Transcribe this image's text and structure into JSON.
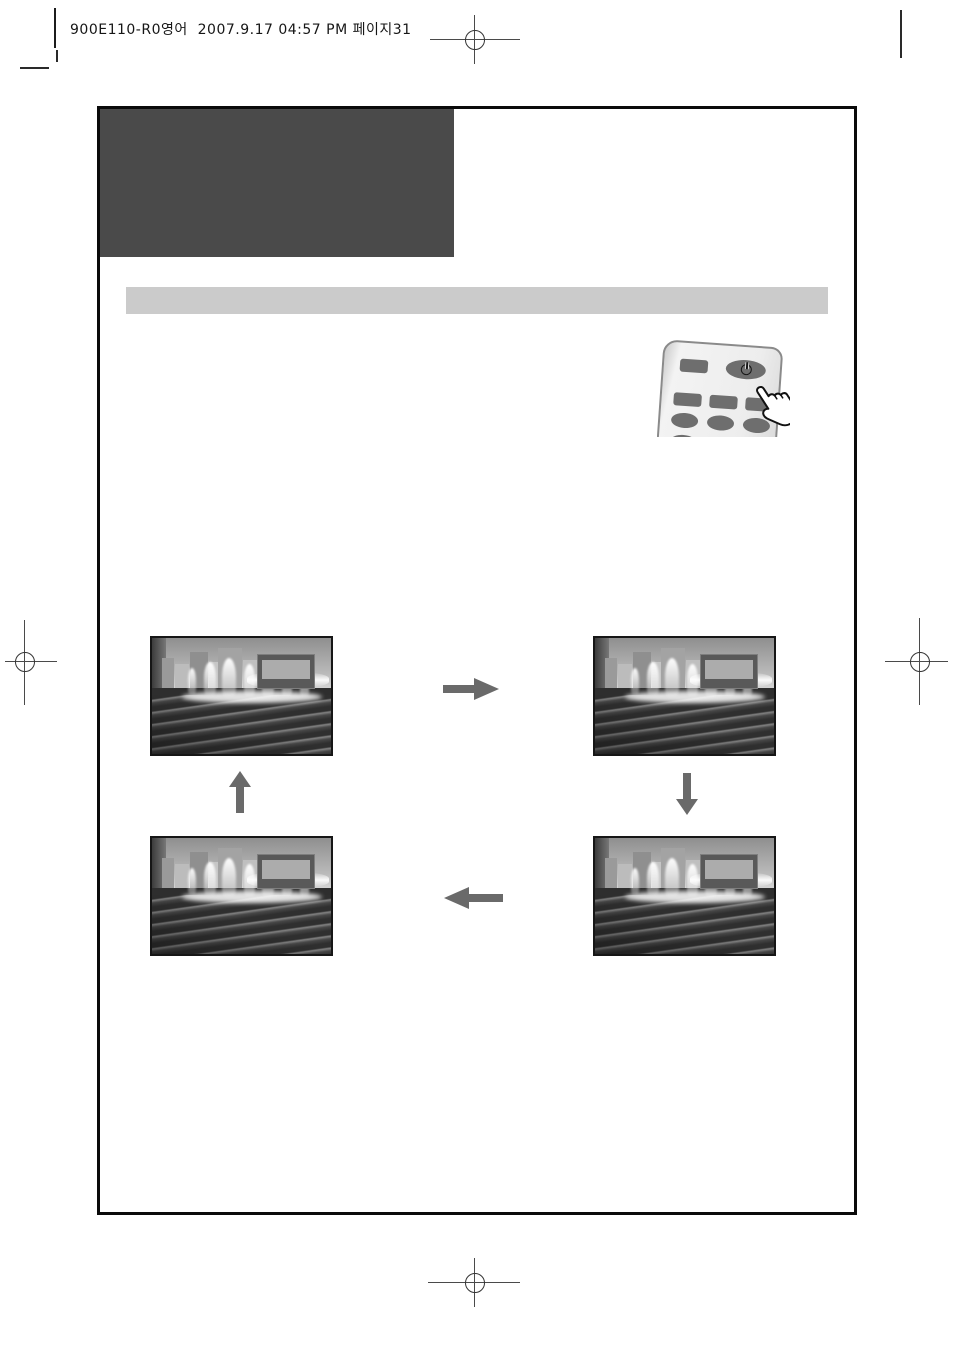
{
  "document": {
    "print_header": "900E110-R0영어  2007.9.17 04:57 PM 페이지31"
  },
  "title_block": {
    "text": ""
  },
  "section_bar": {
    "text": ""
  },
  "remote_illustration": {
    "power_icon": "power-symbol-circle-with-bar",
    "pressed_button": "row2-right-button",
    "hand": "finger-pressing-button"
  },
  "cycle_diagram": {
    "screens": [
      {
        "id": "top-left",
        "content": "fountain-plaza-photo",
        "overlay": "osd-box"
      },
      {
        "id": "top-right",
        "content": "fountain-plaza-photo",
        "overlay": "osd-box"
      },
      {
        "id": "bottom-right",
        "content": "fountain-plaza-photo",
        "overlay": "osd-box"
      },
      {
        "id": "bottom-left",
        "content": "fountain-plaza-photo",
        "overlay": "osd-box"
      }
    ],
    "arrows": [
      {
        "from": "top-left",
        "to": "top-right",
        "direction": "right"
      },
      {
        "from": "top-right",
        "to": "bottom-right",
        "direction": "down"
      },
      {
        "from": "bottom-right",
        "to": "bottom-left",
        "direction": "left"
      },
      {
        "from": "bottom-left",
        "to": "top-left",
        "direction": "up"
      }
    ]
  },
  "colors": {
    "title_block": "#4a4a4a",
    "section_bar": "#cbcbcb",
    "frame_border": "#0a0a0a",
    "arrow": "#6a6a6a",
    "osd_outer": "#595959",
    "osd_inner": "#acacac",
    "remote_body": "#ededed",
    "remote_button": "#6e6e6e"
  }
}
